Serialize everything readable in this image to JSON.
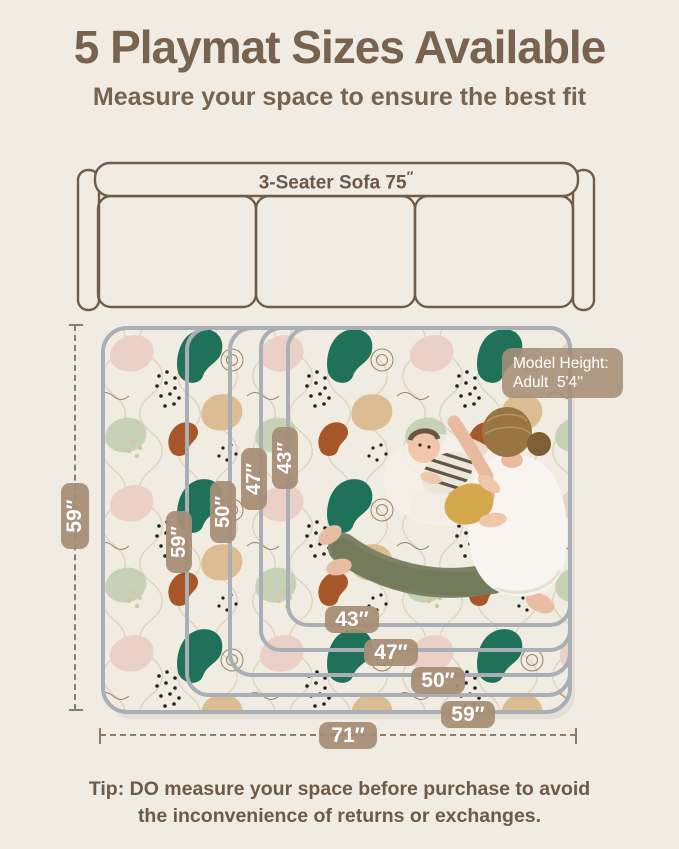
{
  "header": {
    "title": "5 Playmat Sizes Available",
    "subtitle": "Measure your space to ensure the best fit",
    "text_color": "#786350"
  },
  "sofa": {
    "label": "3-Seater Sofa 75",
    "unit_mark": "″"
  },
  "playmat": {
    "outer_height_label": "59″",
    "outer_width_label": "71″",
    "height_labels": [
      "59″",
      "50″",
      "47″",
      "43″"
    ],
    "width_labels": [
      "43″",
      "47″",
      "50″",
      "59″"
    ],
    "model_tag_line1": "Model Height:",
    "model_tag_line2": "Adult  5'4''"
  },
  "tip": {
    "line1": "Tip: DO measure your space before purchase to avoid",
    "line2": "the inconvenience of returns or exchanges."
  },
  "colors": {
    "page_background": "#f0ece3",
    "pill_background": "#a78e76",
    "pill_text": "#ffffff",
    "sofa_outline": "#6f5c49",
    "mat_edge_gray": "#a9afb5",
    "dimension_line": "#8d7c69",
    "tip_text": "#6d5a48",
    "pattern_teal": "#20715a",
    "pattern_rust": "#a65629",
    "pattern_tan": "#dcbd93",
    "pattern_sage": "#c6d1b6",
    "pattern_pink": "#ead0c6"
  }
}
